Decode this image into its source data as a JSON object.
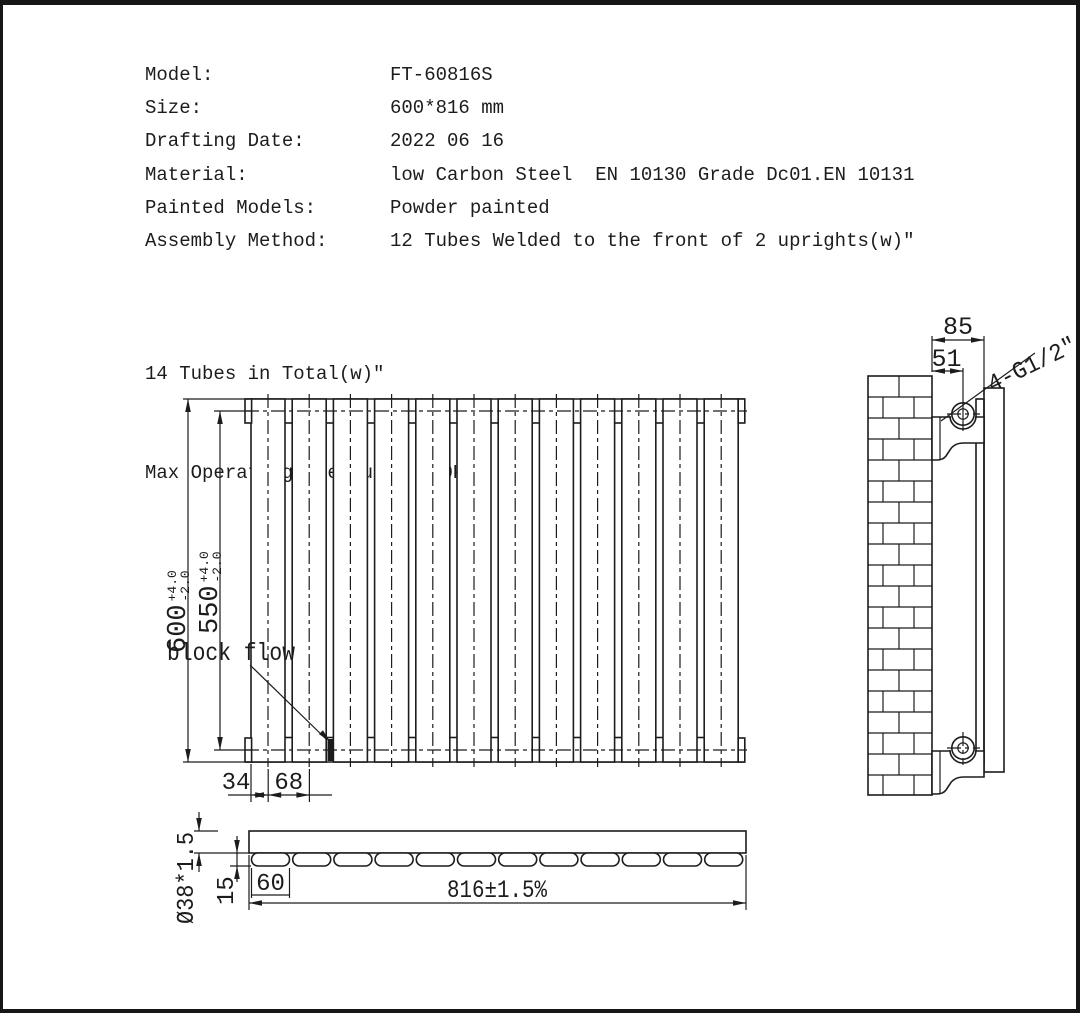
{
  "spec": {
    "rows": [
      {
        "label": "Model:",
        "value": "FT-60816S"
      },
      {
        "label": "Size:",
        "value": "600*816 mm"
      },
      {
        "label": "Drafting Date:",
        "value": "2022 06 16"
      },
      {
        "label": "Material:",
        "value": "low Carbon Steel  EN 10130 Grade Dc01.EN 10131"
      },
      {
        "label": "Painted Models:",
        "value": "Powder painted"
      },
      {
        "label": "Assembly Method:",
        "value": "12 Tubes Welded to the front of 2 uprights(w)″"
      }
    ],
    "note": "14 Tubes in Total(w)″",
    "pressure": "Max Operating Pressure: 400KPA"
  },
  "front_view": {
    "tube_count": 12,
    "dim_height": {
      "value": "600",
      "tol_plus": "+4.0",
      "tol_minus": "-2.0"
    },
    "dim_pitch_height": {
      "value": "550",
      "tol_plus": "+4.0",
      "tol_minus": "-2.0"
    },
    "dim_edge": "34",
    "dim_pitch": "68",
    "annotation": "block flow"
  },
  "side_view": {
    "dim_depth": "85",
    "dim_pipe_center": "51",
    "connection": "4-G1/2\""
  },
  "top_view": {
    "tube_count": 12,
    "dim_tube": "Ø38*1.5",
    "dim_offset": "15",
    "dim_panel_width": "60",
    "dim_length": "816±1.5%"
  },
  "colors": {
    "line": "#1c1c1c",
    "bg": "#ffffff"
  }
}
